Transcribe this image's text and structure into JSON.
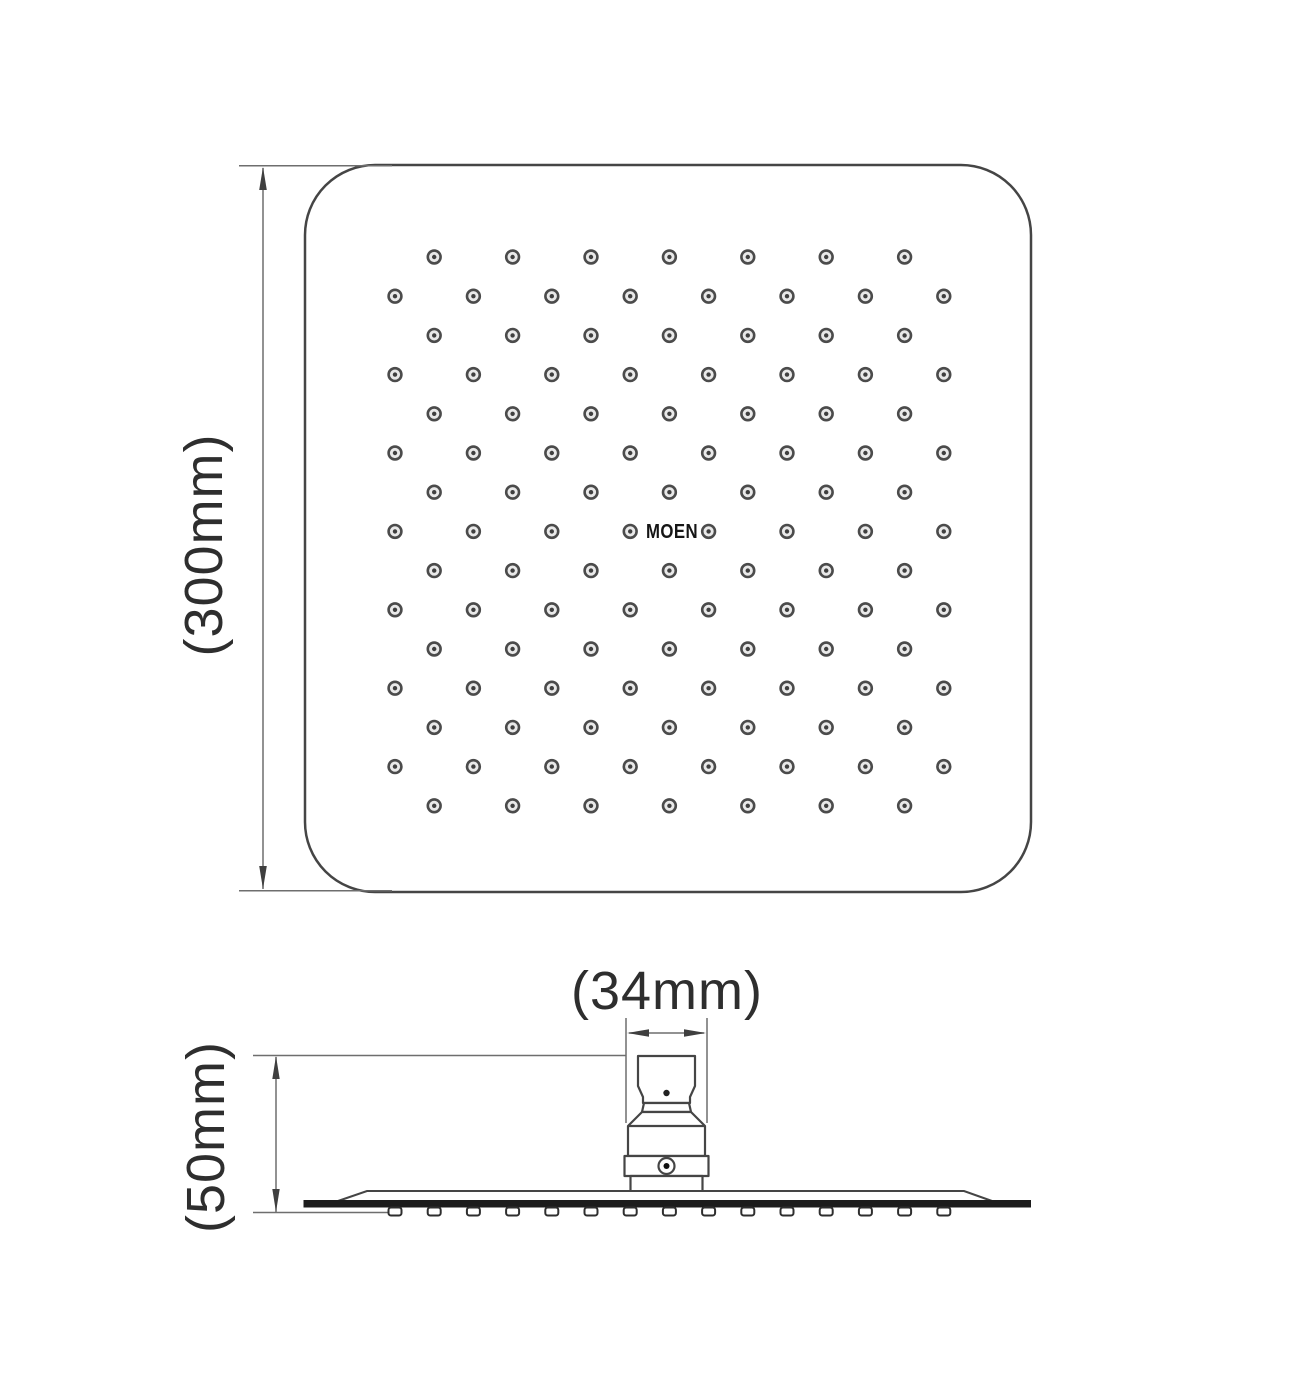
{
  "drawing": {
    "brand": "MOEN",
    "top_view": {
      "dimension_label": "(300mm)",
      "nozzle_rows": 15,
      "dots_per_row_a": 7,
      "dots_per_row_b": 8
    },
    "side_view": {
      "width_label": "(34mm)",
      "height_label": "(50mm)",
      "nozzle_count": 15
    },
    "colors": {
      "line": "#454545",
      "dim_line": "#6e6e6e",
      "plate": "#1c1c1c",
      "text": "#2e2e2e",
      "dot_ring": "#4b4b4b"
    }
  }
}
